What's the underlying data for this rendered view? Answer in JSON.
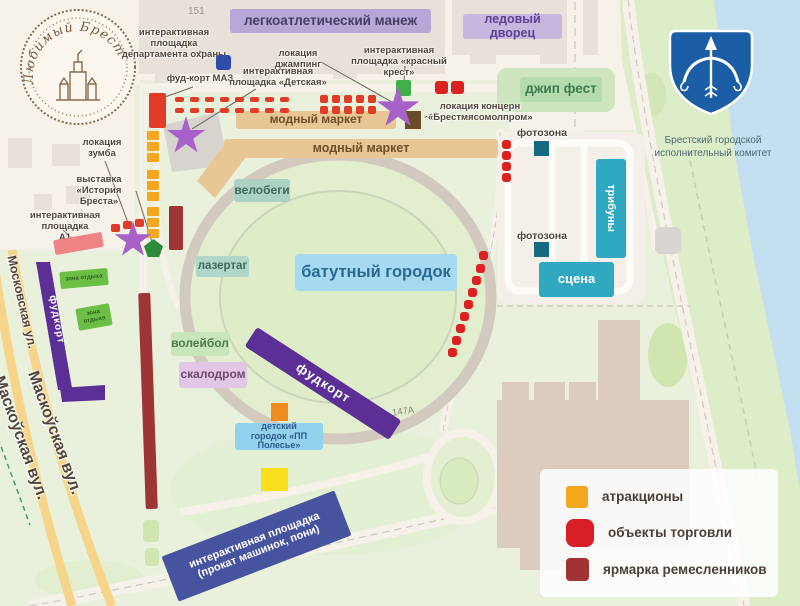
{
  "logo": {
    "text": "Любимый Брест"
  },
  "emblem": {
    "caption_line1": "Брестский городской",
    "caption_line2": "исполнительный комитет"
  },
  "buildings": {
    "n151": "151",
    "n147a": "147А"
  },
  "zones": {
    "manezh": "легкоатлетический манеж",
    "ice_palace": "ледовый дворец",
    "jeep_fest": "джип фест",
    "fashion_market_1": "модный маркет",
    "fashion_market_2": "модный маркет",
    "velobegi": "велобеги",
    "lazertag": "лазертаг",
    "trampoline": "батутный городок",
    "volleyball": "волейбол",
    "climbing": "скалодром",
    "kids_line1": "детский",
    "kids_line2": "городок «ПП Полесье»",
    "stage": "сцена",
    "tribunes": "трибуны",
    "photo_zone_1": "фотозона",
    "photo_zone_2": "фотозона",
    "foodcourt_diagonal": "фудкорт",
    "foodcourt_left": "фудкорт",
    "rental_line1": "интерактивная площадка",
    "rental_line2": "(прокат машинок, пони)",
    "rest_zone_1": "зона отдыха",
    "rest_zone_2": "зона отдыха"
  },
  "annotations": {
    "security_line1": "интерактивная площадка",
    "security_line2": "департамента охраны",
    "maz": "фуд-корт МАЗ",
    "jumping": "локация джампинг",
    "red_cross_line1": "интерактивная",
    "red_cross_line2": "площадка «красный крест»",
    "concern_line1": "локация концерн",
    "concern_line2": "«Брестмясомолпром»",
    "zumba_line1": "локация",
    "zumba_line2": "зумба",
    "exhibition_line1": "выставка",
    "exhibition_line2": "«История Бреста»",
    "a1_line1": "интерактивная площадка",
    "a1_line2": "А1",
    "detskaya_line1": "интерактивная",
    "detskaya_line2": "площадка «Детская»"
  },
  "streets": {
    "moskovskaya": "Московская ул.",
    "maskouskaya_1": "Маскоўская вул.",
    "maskouskaya_2": "Маскоўская вул."
  },
  "legend": {
    "items": [
      {
        "label": "атракционы",
        "color": "#f3a71f"
      },
      {
        "label": "объекты торговли",
        "color": "#d81f26"
      },
      {
        "label": "ярмарка ремесленников",
        "color": "#a03434"
      }
    ]
  },
  "colors": {
    "water": "#c3dff0",
    "park": "#e9f1dc",
    "riverbank": "#dcedc8",
    "urban": "#f6f2ea",
    "building": "#e7e1da",
    "building_big": "#dbccbd",
    "purple_zone": "#5c2f96",
    "star": "#a761c9",
    "teal_zone": "#2fa8c0",
    "market_tan": "#e9c795",
    "blue_banner": "#46549f"
  },
  "markers": [
    {
      "t": "red",
      "x": 175,
      "y": 97,
      "w": 9,
      "h": 5
    },
    {
      "t": "red",
      "x": 190,
      "y": 97,
      "w": 9,
      "h": 5
    },
    {
      "t": "red",
      "x": 205,
      "y": 97,
      "w": 9,
      "h": 5
    },
    {
      "t": "red",
      "x": 220,
      "y": 97,
      "w": 9,
      "h": 5
    },
    {
      "t": "red",
      "x": 235,
      "y": 97,
      "w": 9,
      "h": 5
    },
    {
      "t": "red",
      "x": 250,
      "y": 97,
      "w": 9,
      "h": 5
    },
    {
      "t": "red",
      "x": 265,
      "y": 97,
      "w": 9,
      "h": 5
    },
    {
      "t": "red",
      "x": 280,
      "y": 97,
      "w": 9,
      "h": 5
    },
    {
      "t": "red",
      "x": 175,
      "y": 108,
      "w": 9,
      "h": 5
    },
    {
      "t": "red",
      "x": 190,
      "y": 108,
      "w": 9,
      "h": 5
    },
    {
      "t": "red",
      "x": 205,
      "y": 108,
      "w": 9,
      "h": 5
    },
    {
      "t": "red",
      "x": 220,
      "y": 108,
      "w": 9,
      "h": 5
    },
    {
      "t": "red",
      "x": 235,
      "y": 108,
      "w": 9,
      "h": 5
    },
    {
      "t": "red",
      "x": 250,
      "y": 108,
      "w": 9,
      "h": 5
    },
    {
      "t": "red",
      "x": 265,
      "y": 108,
      "w": 9,
      "h": 5
    },
    {
      "t": "red",
      "x": 280,
      "y": 108,
      "w": 9,
      "h": 5
    },
    {
      "t": "red",
      "x": 320,
      "y": 95,
      "w": 8,
      "h": 8
    },
    {
      "t": "red",
      "x": 332,
      "y": 95,
      "w": 8,
      "h": 8
    },
    {
      "t": "red",
      "x": 344,
      "y": 95,
      "w": 8,
      "h": 8
    },
    {
      "t": "red",
      "x": 356,
      "y": 95,
      "w": 8,
      "h": 8
    },
    {
      "t": "red",
      "x": 368,
      "y": 95,
      "w": 8,
      "h": 8
    },
    {
      "t": "red",
      "x": 320,
      "y": 106,
      "w": 8,
      "h": 8
    },
    {
      "t": "red",
      "x": 332,
      "y": 106,
      "w": 8,
      "h": 8
    },
    {
      "t": "red",
      "x": 344,
      "y": 106,
      "w": 8,
      "h": 8
    },
    {
      "t": "red",
      "x": 356,
      "y": 106,
      "w": 8,
      "h": 8
    },
    {
      "t": "red",
      "x": 368,
      "y": 106,
      "w": 8,
      "h": 8
    },
    {
      "t": "redsq",
      "x": 435,
      "y": 81,
      "w": 13,
      "h": 13
    },
    {
      "t": "redsq",
      "x": 451,
      "y": 81,
      "w": 13,
      "h": 13
    },
    {
      "t": "redsq",
      "x": 502,
      "y": 140,
      "w": 9,
      "h": 9
    },
    {
      "t": "redsq",
      "x": 502,
      "y": 151,
      "w": 9,
      "h": 9
    },
    {
      "t": "redsq",
      "x": 502,
      "y": 162,
      "w": 9,
      "h": 9
    },
    {
      "t": "redsq",
      "x": 502,
      "y": 173,
      "w": 9,
      "h": 9
    },
    {
      "t": "redsq",
      "x": 479,
      "y": 251,
      "w": 9,
      "h": 9
    },
    {
      "t": "redsq",
      "x": 476,
      "y": 264,
      "w": 9,
      "h": 9
    },
    {
      "t": "redsq",
      "x": 472,
      "y": 276,
      "w": 9,
      "h": 9
    },
    {
      "t": "redsq",
      "x": 468,
      "y": 288,
      "w": 9,
      "h": 9
    },
    {
      "t": "redsq",
      "x": 464,
      "y": 300,
      "w": 9,
      "h": 9
    },
    {
      "t": "redsq",
      "x": 460,
      "y": 312,
      "w": 9,
      "h": 9
    },
    {
      "t": "redsq",
      "x": 456,
      "y": 324,
      "w": 9,
      "h": 9
    },
    {
      "t": "redsq",
      "x": 452,
      "y": 336,
      "w": 9,
      "h": 9
    },
    {
      "t": "redsq",
      "x": 448,
      "y": 348,
      "w": 9,
      "h": 9
    },
    {
      "t": "red",
      "x": 111,
      "y": 224,
      "w": 9,
      "h": 8
    },
    {
      "t": "red",
      "x": 123,
      "y": 221,
      "w": 9,
      "h": 8
    },
    {
      "t": "red",
      "x": 135,
      "y": 219,
      "w": 9,
      "h": 8
    },
    {
      "t": "red",
      "x": 149,
      "y": 93,
      "w": 17,
      "h": 35
    },
    {
      "t": "orange",
      "x": 147,
      "y": 131,
      "w": 12,
      "h": 9
    },
    {
      "t": "orange",
      "x": 147,
      "y": 142,
      "w": 12,
      "h": 9
    },
    {
      "t": "orange",
      "x": 147,
      "y": 153,
      "w": 12,
      "h": 9
    },
    {
      "t": "orange",
      "x": 147,
      "y": 170,
      "w": 12,
      "h": 9
    },
    {
      "t": "orange",
      "x": 147,
      "y": 181,
      "w": 12,
      "h": 9
    },
    {
      "t": "orange",
      "x": 147,
      "y": 192,
      "w": 12,
      "h": 9
    },
    {
      "t": "orange",
      "x": 147,
      "y": 207,
      "w": 12,
      "h": 9
    },
    {
      "t": "orange",
      "x": 147,
      "y": 218,
      "w": 12,
      "h": 9
    },
    {
      "t": "orange",
      "x": 147,
      "y": 229,
      "w": 12,
      "h": 9
    },
    {
      "t": "darkred",
      "x": 169,
      "y": 206,
      "w": 14,
      "h": 44
    },
    {
      "t": "darkred",
      "x": 142,
      "y": 293,
      "w": 12,
      "h": 216,
      "r": -2
    },
    {
      "t": "pink",
      "x": 54,
      "y": 236,
      "w": 49,
      "h": 15,
      "r": -10
    },
    {
      "t": "blue",
      "x": 216,
      "y": 55,
      "w": 15,
      "h": 15
    },
    {
      "t": "green",
      "x": 396,
      "y": 80,
      "w": 15,
      "h": 16
    },
    {
      "t": "brown",
      "x": 405,
      "y": 111,
      "w": 16,
      "h": 18
    },
    {
      "t": "teal",
      "x": 534,
      "y": 141,
      "w": 15,
      "h": 15
    },
    {
      "t": "teal",
      "x": 534,
      "y": 242,
      "w": 15,
      "h": 15
    },
    {
      "t": "orangelg",
      "x": 271,
      "y": 403,
      "w": 17,
      "h": 18
    },
    {
      "t": "yellow",
      "x": 261,
      "y": 468,
      "w": 27,
      "h": 23
    },
    {
      "t": "pent",
      "x": 144,
      "y": 239,
      "w": 19,
      "h": 18
    },
    {
      "t": "star",
      "x": 166,
      "y": 116,
      "w": 40,
      "h": 40
    },
    {
      "t": "star",
      "x": 114,
      "y": 221,
      "w": 38,
      "h": 38
    },
    {
      "t": "star",
      "x": 376,
      "y": 86,
      "w": 44,
      "h": 44
    }
  ]
}
